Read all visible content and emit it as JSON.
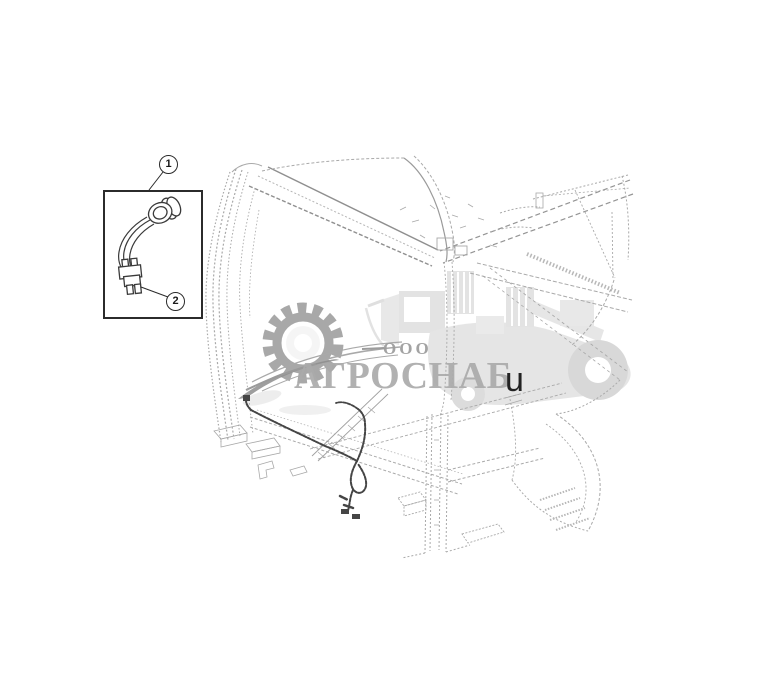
{
  "callout": {
    "item_1_label": "1",
    "item_2_label": "2"
  },
  "watermark": {
    "org_type": "ООО",
    "company": "АГРОСНАБ",
    "icons": [
      "gear-icon",
      "combine-harvester-icon",
      "swoosh-graphic"
    ],
    "text_color": "#ababab",
    "org_type_color": "#9c9c9c",
    "silhouette_color": "#e2e2e2"
  },
  "overlay": {
    "stray_char": "u",
    "stray_char_color": "#222222"
  },
  "drawing": {
    "line_color": "#a9a9a9",
    "accent_line_color": "#8f8f8f",
    "harness_color": "#454545",
    "callout_border_color": "#2b2b2b"
  }
}
